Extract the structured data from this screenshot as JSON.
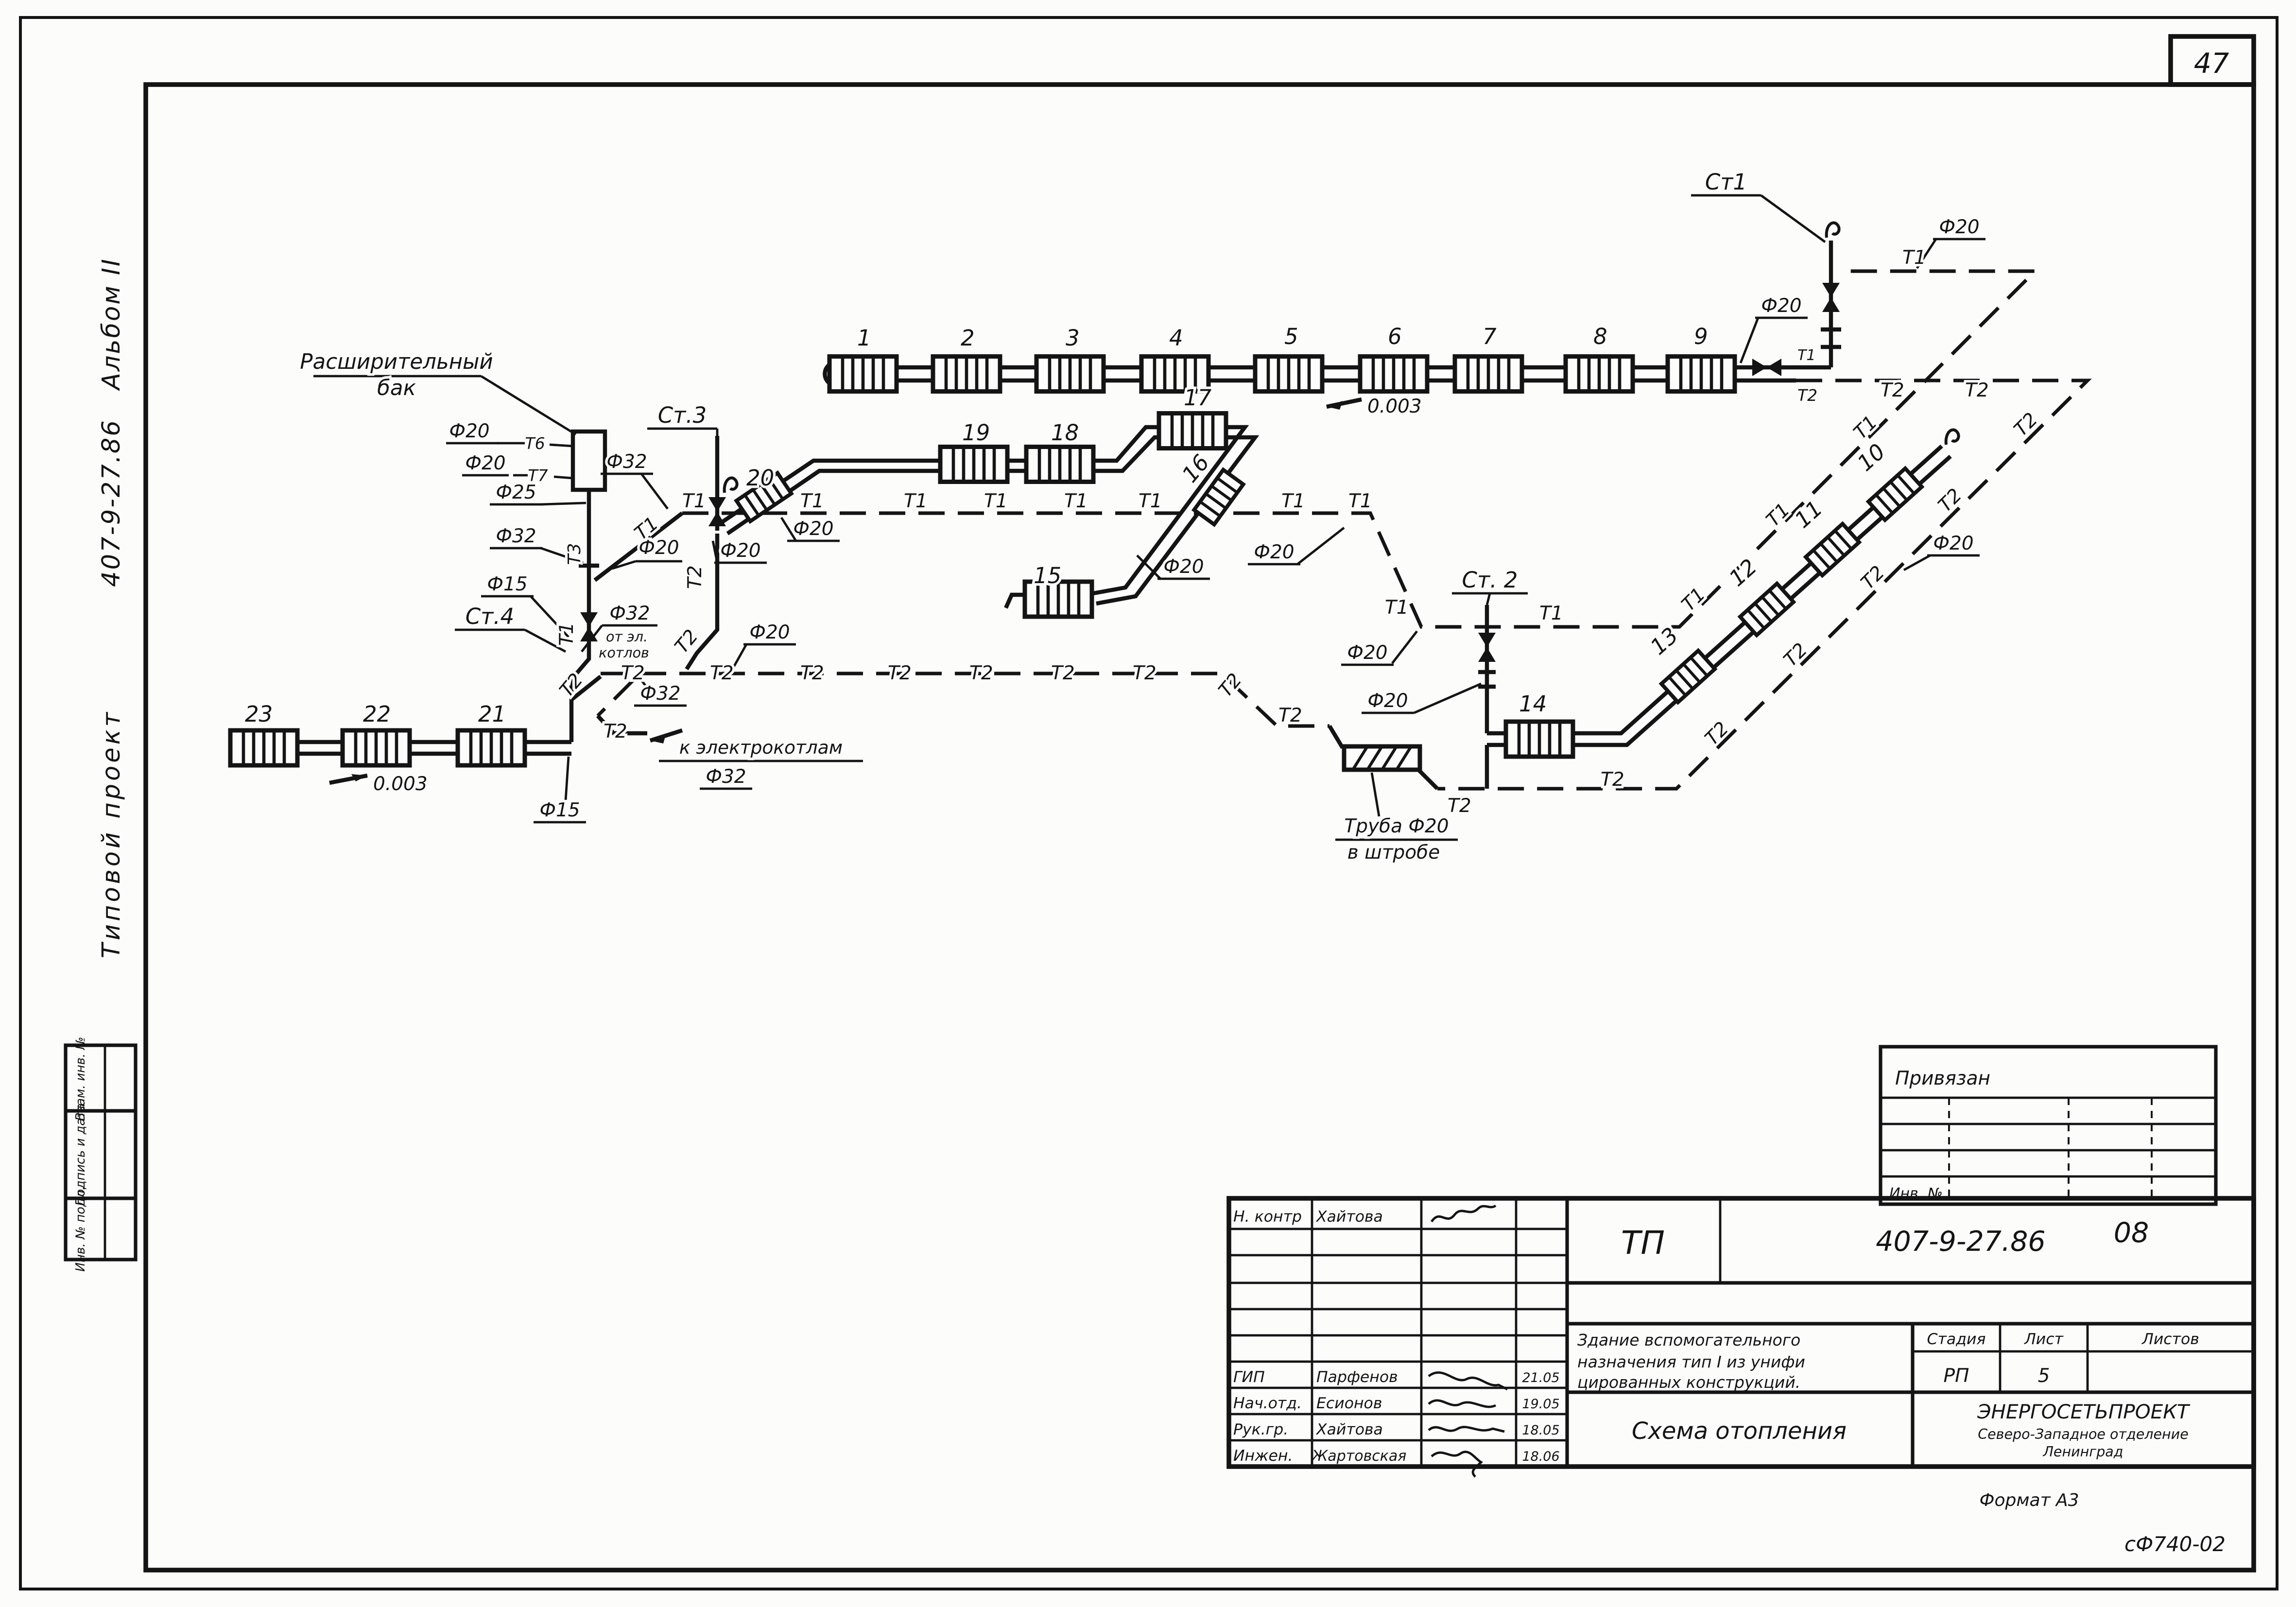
{
  "page": {
    "number": "47",
    "format_note": "Формат А3",
    "form_code": "сФ740-02"
  },
  "side": {
    "project_type": "Типовой проект",
    "project_code": "407-9-27.86",
    "album": "Альбом II",
    "stamps": {
      "vzam": "Взам. инв. №",
      "podpis": "Подпись и дата",
      "inv": "Инв. № подл."
    }
  },
  "labels": {
    "t1": "Т1",
    "t2": "Т2",
    "t3": "Т3",
    "t6": "Т6",
    "t7": "Т7",
    "d15": "Ф15",
    "d20": "Ф20",
    "d25": "Ф25",
    "d32": "Ф32",
    "slope": "0.003",
    "st1": "Ст1",
    "st2": "Ст. 2",
    "st3": "Ст.3",
    "st4": "Ст.4",
    "tank_line1": "Расширительный",
    "tank_line2": "бак",
    "to_boilers": "к электрокотлам",
    "from_boilers_1": "от эл.",
    "from_boilers_2": "котлов",
    "chase_line1": "Труба Ф20",
    "chase_line2": "в штробе"
  },
  "radiators": {
    "r1": "1",
    "r2": "2",
    "r3": "3",
    "r4": "4",
    "r5": "5",
    "r6": "6",
    "r7": "7",
    "r8": "8",
    "r9": "9",
    "r10": "10",
    "r11": "11",
    "r12": "12",
    "r13": "13",
    "r14": "14",
    "r15": "15",
    "r16": "16",
    "r17": "17",
    "r18": "18",
    "r19": "19",
    "r20": "20",
    "r21": "21",
    "r22": "22",
    "r23": "23"
  },
  "binding_block": {
    "title": "Привязан",
    "inv_label": "Инв. №"
  },
  "titleblock": {
    "tp": "ТП",
    "doc_number": "407-9-27.86",
    "doc_suffix": "08",
    "object_line1": "Здание вспомогательного",
    "object_line2": "назначения тип I из унифи",
    "object_line3": "цированных конструкций.",
    "stage_label": "Стадия",
    "sheet_label": "Лист",
    "sheets_label": "Листов",
    "stage": "РП",
    "sheet": "5",
    "drawing_title": "Схема отопления",
    "org": "ЭНЕРГОСЕТЬПРОЕКТ",
    "org_branch": "Северо-Западное отделение",
    "org_city": "Ленинград",
    "rows": [
      {
        "role": "Н. контр",
        "name": "Хайтова",
        "date": ""
      },
      {
        "role": "ГИП",
        "name": "Парфенов",
        "date": "21.05"
      },
      {
        "role": "Нач.отд.",
        "name": "Есионов",
        "date": "19.05"
      },
      {
        "role": "Рук.гр.",
        "name": "Хайтова",
        "date": "18.05"
      },
      {
        "role": "Инжен.",
        "name": "Жартовская",
        "date": "18.06"
      }
    ]
  }
}
